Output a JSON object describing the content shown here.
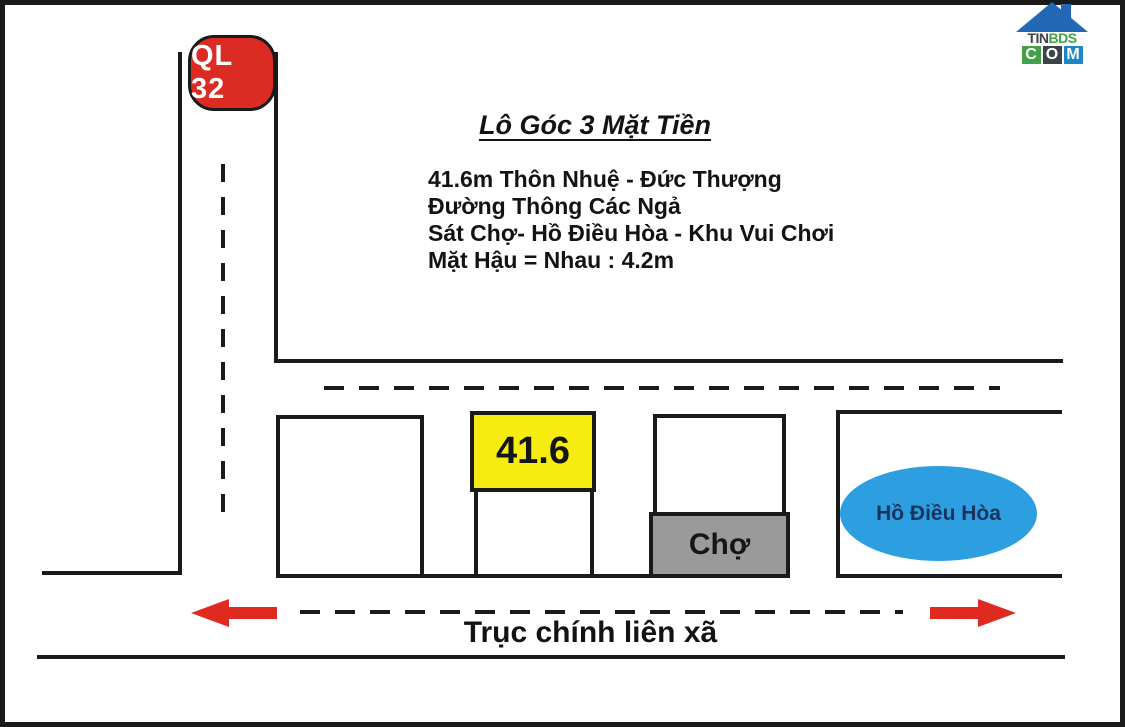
{
  "watermark": {
    "top_text_part1": "TIN",
    "top_text_part2": "BDS",
    "bottom_letters": [
      "C",
      "O",
      "M"
    ]
  },
  "highway_badge": {
    "label": "QL 32"
  },
  "heading": {
    "title": "Lô Góc 3 Mặt Tiền"
  },
  "description": {
    "lines": [
      "41.6m Thôn Nhuệ - Đức Thượng",
      "Đường Thông Các Ngả",
      "Sát Chợ- Hồ Điều Hòa - Khu Vui Chơi",
      "Mặt Hậu = Nhau : 4.2m"
    ]
  },
  "plot": {
    "area_label": "41.6"
  },
  "market": {
    "label": "Chợ"
  },
  "lake": {
    "label": "Hồ Điều Hòa"
  },
  "main_road": {
    "label": "Trục chính liên xã"
  },
  "colors": {
    "line_black": "#1a1a1a",
    "badge_red": "#dc2b22",
    "arrow_red": "#e02a1f",
    "plot_yellow": "#f7ec0f",
    "market_gray": "#9a9a9a",
    "lake_blue": "#2d9fe0",
    "lake_text": "#16335e",
    "logo_roof_blue": "#2268b5",
    "logo_green": "#43a047",
    "logo_dark": "#3e4347",
    "logo_blue": "#1e88c7"
  }
}
